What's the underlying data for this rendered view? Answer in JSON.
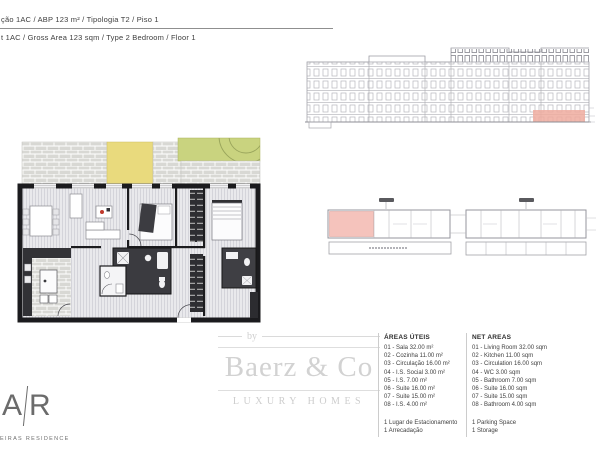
{
  "page": {
    "title_pt": "ção 1AC  /  ABP 123 m²  /  Tipologia T2  /  Piso 1",
    "title_en": "t 1AC  /  Gross Area 123 sqm  /  Type 2 Bedroom  /  Floor 1"
  },
  "legend_pt": {
    "title": "ÁREAS ÚTEIS",
    "items": [
      "01 - Sala 32.00 m²",
      "02 - Cozinha 11.00 m²",
      "03 - Circulação 16.00 m²",
      "04 - I.S. Social 3.00 m²",
      "05 - I.S. 7.00 m²",
      "06 - Suite 16.00 m²",
      "07 - Suite 15.00 m²",
      "08 - I.S. 4.00 m²"
    ],
    "extras": [
      "1 Lugar de Estacionamento",
      "1 Arrecadação"
    ]
  },
  "legend_en": {
    "title": "NET AREAS",
    "items": [
      "01 - Living Room 32.00 sqm",
      "02 - Kitchen 11.00 sqm",
      "03 - Circulation 16.00 sqm",
      "04 - WC 3.00 sqm",
      "05 - Bathroom 7.00 sqm",
      "06 - Suite 16.00 sqm",
      "07 - Suite 15.00 sqm",
      "08 - Bathroom 4.00 sqm"
    ],
    "extras": [
      "1 Parking Space",
      "1 Storage"
    ]
  },
  "watermark": {
    "prefix": "by",
    "brand": "Baerz & Co",
    "tagline": "LUXURY HOMES"
  },
  "logo": {
    "left": "A",
    "right": "R",
    "subtext": "EIRAS RESIDENCE"
  },
  "colors": {
    "terrace_yellow": "#e9da7d",
    "garden_green": "#c9d37f",
    "paver_gray": "#d8d8d4",
    "wall_black": "#1b1b1e",
    "plan_floor": "#e9e9ec",
    "unit_highlight_pink": "#f5c3bc",
    "elevation_highlight_red": "#efab9f",
    "watermark_gray": "#d0d0d0"
  }
}
